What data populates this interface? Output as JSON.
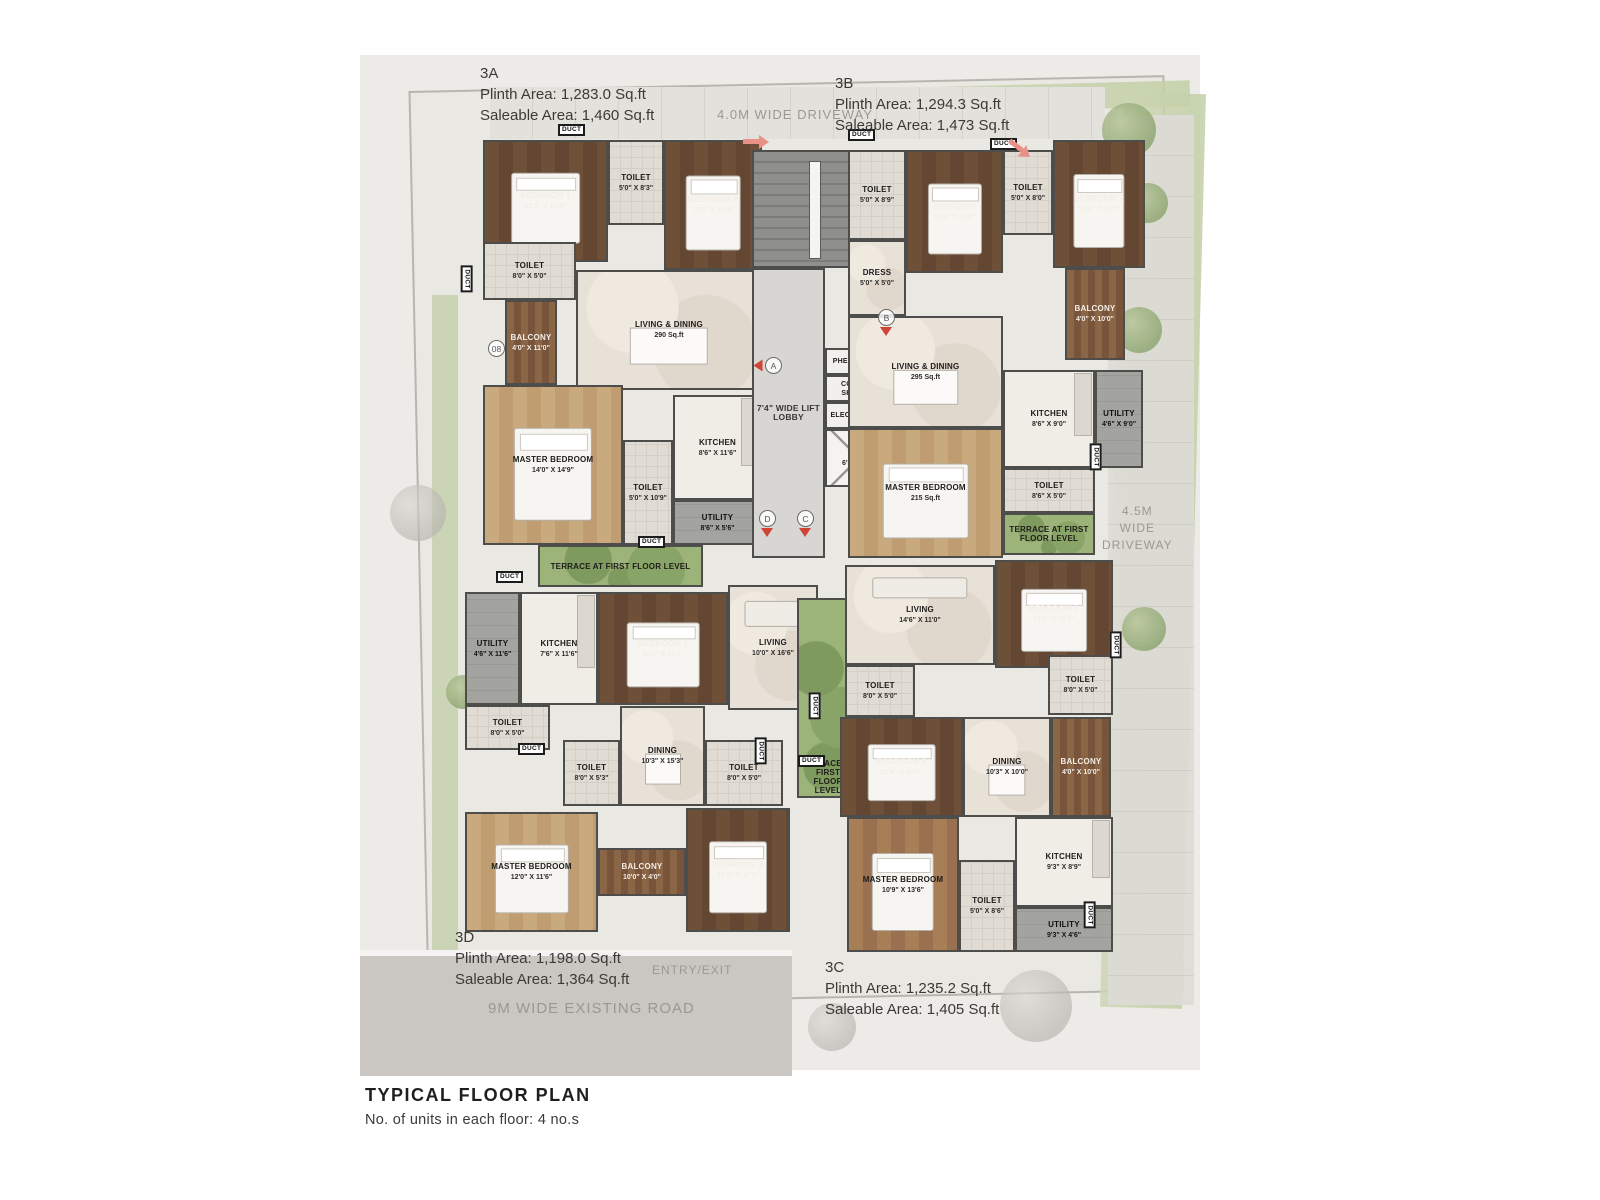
{
  "title_block": {
    "title": "TYPICAL FLOOR PLAN",
    "subtitle": "No. of units in each floor: 4 no.s"
  },
  "site": {
    "road_label": "9M WIDE EXISTING ROAD",
    "entry_label": "ENTRY/EXIT",
    "driveway_top": "4.0M WIDE DRIVEWAY",
    "driveway_right": [
      "4.5M",
      "WIDE",
      "DRIVEWAY"
    ]
  },
  "duct_label": "DUCT",
  "units": [
    {
      "id": "3A",
      "plinth": "Plinth Area: 1,283.0 Sq.ft",
      "saleable": "Saleable Area: 1,460 Sq.ft"
    },
    {
      "id": "3B",
      "plinth": "Plinth Area: 1,294.3 Sq.ft",
      "saleable": "Saleable Area: 1,473 Sq.ft"
    },
    {
      "id": "3D",
      "plinth": "Plinth Area: 1,198.0 Sq.ft",
      "saleable": "Saleable Area: 1,364 Sq.ft"
    },
    {
      "id": "3C",
      "plinth": "Plinth Area: 1,235.2 Sq.ft",
      "saleable": "Saleable Area: 1,405 Sq.ft"
    }
  ],
  "colors": {
    "wall": "#4d4d4b",
    "accent_red": "#cf4436"
  },
  "rooms": [
    {
      "u": "3A",
      "n": "BEDROOM 1",
      "d": "11'3\" X 10'9\"",
      "x": 123,
      "y": 85,
      "w": 125,
      "h": 122,
      "t": "wood-dark",
      "f": "bed"
    },
    {
      "u": "3A",
      "n": "TOILET",
      "d": "5'0\" X 8'3\"",
      "x": 248,
      "y": 85,
      "w": 56,
      "h": 85,
      "t": "tile"
    },
    {
      "u": "3A",
      "n": "BEDROOM 2",
      "d": "10'6\" X 13'9\"",
      "x": 304,
      "y": 85,
      "w": 98,
      "h": 130,
      "t": "wood-dark",
      "f": "bed"
    },
    {
      "u": "3A",
      "n": "TOILET",
      "d": "8'0\" X 5'0\"",
      "x": 123,
      "y": 187,
      "w": 93,
      "h": 58,
      "t": "tile"
    },
    {
      "u": "3A",
      "n": "BALCONY",
      "d": "4'0\" X 11'0\"",
      "x": 145,
      "y": 245,
      "w": 52,
      "h": 85,
      "t": "balcony"
    },
    {
      "u": "3A",
      "n": "LIVING & DINING",
      "d": "290 Sq.ft",
      "x": 216,
      "y": 215,
      "w": 186,
      "h": 120,
      "t": "marble",
      "f": "table"
    },
    {
      "u": "3A",
      "n": "MASTER BEDROOM",
      "d": "14'0\" X 14'9\"",
      "x": 123,
      "y": 330,
      "w": 140,
      "h": 160,
      "t": "wood-light",
      "f": "bed"
    },
    {
      "u": "3A",
      "n": "TOILET",
      "d": "5'0\" X 10'9\"",
      "x": 263,
      "y": 385,
      "w": 50,
      "h": 105,
      "t": "tile"
    },
    {
      "u": "3A",
      "n": "KITCHEN",
      "d": "8'6\" X 11'6\"",
      "x": 313,
      "y": 340,
      "w": 89,
      "h": 105,
      "t": "kitchen"
    },
    {
      "u": "3A",
      "n": "UTILITY",
      "d": "8'6\" X 5'6\"",
      "x": 313,
      "y": 445,
      "w": 89,
      "h": 45,
      "t": "utility"
    },
    {
      "u": "3A",
      "n": "TERRACE AT FIRST FLOOR LEVEL",
      "d": null,
      "x": 178,
      "y": 490,
      "w": 165,
      "h": 42,
      "t": "terrace"
    },
    {
      "u": "core",
      "n": "",
      "d": null,
      "x": 392,
      "y": 95,
      "w": 123,
      "h": 118,
      "t": "stair"
    },
    {
      "u": "core",
      "n": "7'4\" WIDE LIFT LOBBY",
      "d": null,
      "x": 392,
      "y": 213,
      "w": 73,
      "h": 290,
      "t": "lobby"
    },
    {
      "u": "core",
      "n": "PHE SHAFT",
      "d": null,
      "x": 465,
      "y": 293,
      "w": 57,
      "h": 27,
      "t": "shaft"
    },
    {
      "u": "core",
      "n": "COMM. SHAFT",
      "d": null,
      "x": 465,
      "y": 320,
      "w": 57,
      "h": 27,
      "t": "shaft"
    },
    {
      "u": "core",
      "n": "ELEC SHAFT",
      "d": null,
      "x": 465,
      "y": 347,
      "w": 57,
      "h": 27,
      "t": "shaft"
    },
    {
      "u": "core",
      "n": "LIFT",
      "d": "6'3\" X 6'0\"",
      "x": 465,
      "y": 374,
      "w": 68,
      "h": 58,
      "t": "lift"
    },
    {
      "u": "3B",
      "n": "TOILET",
      "d": "5'0\" X 8'9\"",
      "x": 488,
      "y": 95,
      "w": 58,
      "h": 90,
      "t": "tile"
    },
    {
      "u": "3B",
      "n": "BEDROOM",
      "d": "10'3\" X 13'0\"",
      "x": 546,
      "y": 95,
      "w": 97,
      "h": 123,
      "t": "wood-dark",
      "f": "bed"
    },
    {
      "u": "3B",
      "n": "TOILET",
      "d": "5'0\" X 8'0\"",
      "x": 643,
      "y": 95,
      "w": 50,
      "h": 85,
      "t": "tile"
    },
    {
      "u": "3B",
      "n": "BEDROOM 2",
      "d": "10'3\" X 13'0\"",
      "x": 693,
      "y": 85,
      "w": 92,
      "h": 128,
      "t": "wood-dark",
      "f": "bed"
    },
    {
      "u": "3B",
      "n": "DRESS",
      "d": "5'0\" X 5'0\"",
      "x": 488,
      "y": 185,
      "w": 58,
      "h": 76,
      "t": "marble"
    },
    {
      "u": "3B",
      "n": "BALCONY",
      "d": "4'0\" X 10'0\"",
      "x": 705,
      "y": 213,
      "w": 60,
      "h": 92,
      "t": "balcony"
    },
    {
      "u": "3B",
      "n": "LIVING & DINING",
      "d": "295 Sq.ft",
      "x": 488,
      "y": 261,
      "w": 155,
      "h": 112,
      "t": "marble",
      "f": "table"
    },
    {
      "u": "3B",
      "n": "KITCHEN",
      "d": "8'6\" X 9'0\"",
      "x": 643,
      "y": 315,
      "w": 92,
      "h": 98,
      "t": "kitchen"
    },
    {
      "u": "3B",
      "n": "UTILITY",
      "d": "4'6\" X 9'0\"",
      "x": 735,
      "y": 315,
      "w": 48,
      "h": 98,
      "t": "utility"
    },
    {
      "u": "3B",
      "n": "MASTER BEDROOM",
      "d": "215 Sq.ft",
      "x": 488,
      "y": 373,
      "w": 155,
      "h": 130,
      "t": "wood-light",
      "f": "bed"
    },
    {
      "u": "3B",
      "n": "TOILET",
      "d": "8'6\" X 5'0\"",
      "x": 643,
      "y": 413,
      "w": 92,
      "h": 45,
      "t": "tile"
    },
    {
      "u": "3B",
      "n": "TERRACE AT FIRST FLOOR LEVEL",
      "d": null,
      "x": 643,
      "y": 458,
      "w": 92,
      "h": 42,
      "t": "terrace"
    },
    {
      "u": "3D",
      "n": "UTILITY",
      "d": "4'6\" X 11'6\"",
      "x": 105,
      "y": 537,
      "w": 55,
      "h": 113,
      "t": "utility"
    },
    {
      "u": "3D",
      "n": "KITCHEN",
      "d": "7'6\" X 11'6\"",
      "x": 160,
      "y": 537,
      "w": 78,
      "h": 113,
      "t": "kitchen"
    },
    {
      "u": "3D",
      "n": "BEDROOM 1",
      "d": "10'3\" X 11'6\"",
      "x": 238,
      "y": 537,
      "w": 130,
      "h": 113,
      "t": "wood-dark",
      "f": "bed"
    },
    {
      "u": "3D",
      "n": "LIVING",
      "d": "10'0\" X 16'6\"",
      "x": 368,
      "y": 530,
      "w": 90,
      "h": 125,
      "t": "marble",
      "f": "sofa"
    },
    {
      "u": "3D",
      "n": "TOILET",
      "d": "8'0\" X 5'0\"",
      "x": 105,
      "y": 650,
      "w": 85,
      "h": 45,
      "t": "tile"
    },
    {
      "u": "3D",
      "n": "TOILET",
      "d": "8'0\" X 5'3\"",
      "x": 203,
      "y": 685,
      "w": 57,
      "h": 66,
      "t": "tile"
    },
    {
      "u": "3D",
      "n": "DINING",
      "d": "10'3\" X 15'3\"",
      "x": 260,
      "y": 651,
      "w": 85,
      "h": 100,
      "t": "marble",
      "f": "table"
    },
    {
      "u": "3D",
      "n": "TOILET",
      "d": "8'0\" X 5'0\"",
      "x": 345,
      "y": 685,
      "w": 78,
      "h": 66,
      "t": "tile"
    },
    {
      "u": "3D",
      "n": "MASTER BEDROOM",
      "d": "12'0\" X 11'6\"",
      "x": 105,
      "y": 757,
      "w": 133,
      "h": 120,
      "t": "wood-light",
      "f": "bed"
    },
    {
      "u": "3D",
      "n": "BALCONY",
      "d": "10'0\" X 4'0\"",
      "x": 238,
      "y": 793,
      "w": 88,
      "h": 48,
      "t": "balcony"
    },
    {
      "u": "3D",
      "n": "BEDROOM 2",
      "d": "10'0\" X 12'0\"",
      "x": 326,
      "y": 753,
      "w": 104,
      "h": 124,
      "t": "wood-dark",
      "f": "bed"
    },
    {
      "u": "center",
      "n": "TERRACE AT FIRST FLOOR LEVEL",
      "d": null,
      "x": 437,
      "y": 543,
      "w": 62,
      "h": 200,
      "t": "terrace-tall"
    },
    {
      "u": "3C",
      "n": "LIVING",
      "d": "14'6\" X 11'0\"",
      "x": 485,
      "y": 510,
      "w": 150,
      "h": 100,
      "t": "marble",
      "f": "sofa"
    },
    {
      "u": "3C",
      "n": "BEDROOM 1",
      "d": "13'6\" X 11'0\"",
      "x": 635,
      "y": 505,
      "w": 118,
      "h": 108,
      "t": "wood-dark",
      "f": "bed"
    },
    {
      "u": "3C",
      "n": "TOILET",
      "d": "8'0\" X 5'0\"",
      "x": 485,
      "y": 610,
      "w": 70,
      "h": 52,
      "t": "tile"
    },
    {
      "u": "3C",
      "n": "TOILET",
      "d": "8'0\" X 5'0\"",
      "x": 688,
      "y": 600,
      "w": 65,
      "h": 60,
      "t": "tile"
    },
    {
      "u": "3C",
      "n": "BEDROOM 2",
      "d": "11'9\" X 10'0\"",
      "x": 480,
      "y": 662,
      "w": 123,
      "h": 100,
      "t": "wood-dark",
      "f": "bed"
    },
    {
      "u": "3C",
      "n": "DINING",
      "d": "10'3\" X 10'0\"",
      "x": 603,
      "y": 662,
      "w": 88,
      "h": 100,
      "t": "marble",
      "f": "table"
    },
    {
      "u": "3C",
      "n": "BALCONY",
      "d": "4'0\" X 10'0\"",
      "x": 691,
      "y": 662,
      "w": 60,
      "h": 100,
      "t": "balcony"
    },
    {
      "u": "3C",
      "n": "MASTER BEDROOM",
      "d": "10'9\" X 13'6\"",
      "x": 487,
      "y": 762,
      "w": 112,
      "h": 135,
      "t": "wood-mid",
      "f": "bed"
    },
    {
      "u": "3C",
      "n": "TOILET",
      "d": "5'0\" X 8'6\"",
      "x": 599,
      "y": 805,
      "w": 56,
      "h": 92,
      "t": "tile"
    },
    {
      "u": "3C",
      "n": "KITCHEN",
      "d": "9'3\" X 8'9\"",
      "x": 655,
      "y": 762,
      "w": 98,
      "h": 90,
      "t": "kitchen"
    },
    {
      "u": "3C",
      "n": "UTILITY",
      "d": "9'3\" X 4'6\"",
      "x": 655,
      "y": 852,
      "w": 98,
      "h": 45,
      "t": "utility"
    }
  ],
  "markers": [
    {
      "t": "A",
      "x": 405,
      "y": 302,
      "tri": "left"
    },
    {
      "t": "B",
      "x": 518,
      "y": 254,
      "tri": "down"
    },
    {
      "t": "D",
      "x": 399,
      "y": 455,
      "tri": "down"
    },
    {
      "t": "C",
      "x": 437,
      "y": 455,
      "tri": "down"
    },
    {
      "t": "08",
      "x": 128,
      "y": 285,
      "tri": null
    }
  ],
  "ducts": [
    {
      "x": 198,
      "y": 69,
      "v": false
    },
    {
      "x": 488,
      "y": 74,
      "v": false
    },
    {
      "x": 630,
      "y": 83,
      "v": false
    },
    {
      "x": 93,
      "y": 218,
      "v": true
    },
    {
      "x": 278,
      "y": 481,
      "v": false
    },
    {
      "x": 136,
      "y": 516,
      "v": false
    },
    {
      "x": 158,
      "y": 688,
      "v": false
    },
    {
      "x": 387,
      "y": 690,
      "v": true
    },
    {
      "x": 441,
      "y": 645,
      "v": true
    },
    {
      "x": 438,
      "y": 700,
      "v": false
    },
    {
      "x": 722,
      "y": 396,
      "v": true
    },
    {
      "x": 742,
      "y": 584,
      "v": true
    },
    {
      "x": 716,
      "y": 854,
      "v": true
    }
  ]
}
